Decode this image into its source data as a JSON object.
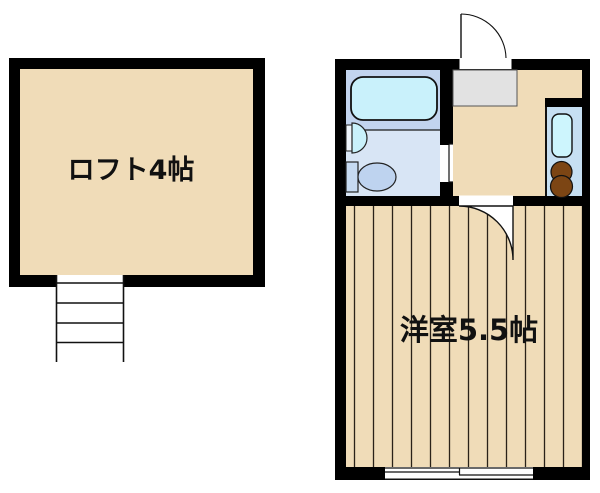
{
  "rooms": {
    "loft": {
      "label": "ロフト4帖"
    },
    "western_room": {
      "label": "洋室5.5帖"
    }
  },
  "fixtures": {
    "bathtub": "bathtub",
    "washbasin": "washbasin",
    "toilet": "toilet",
    "kitchen_sink": "kitchen-sink",
    "stove": "two-burner-stove",
    "stairs": "stairs-to-loft",
    "entrance_door": "entrance-door-swing",
    "bathroom_door": "bathroom-door-swing",
    "room_door": "room-door-swing",
    "window": "sliding-window",
    "genkan": "entry-step"
  },
  "colors": {
    "wall": "#000000",
    "floor_tan": "#f0dcb8",
    "bath_floor_upper": "#c2d4ee",
    "bath_floor_lower": "#d8e5f5",
    "fixture_cyan": "#c9f1fb",
    "toilet_blue": "#bed3ef",
    "tank_blue": "#c6daf1",
    "genkan_gray": "#e2e2e2",
    "kitchen_bg": "#c6dff2",
    "kitchen_sink_cyan": "#cdf5fd",
    "burner_brown": "#7c4514",
    "floorboard_line": "#2a2218",
    "door_white": "#ffffff"
  }
}
